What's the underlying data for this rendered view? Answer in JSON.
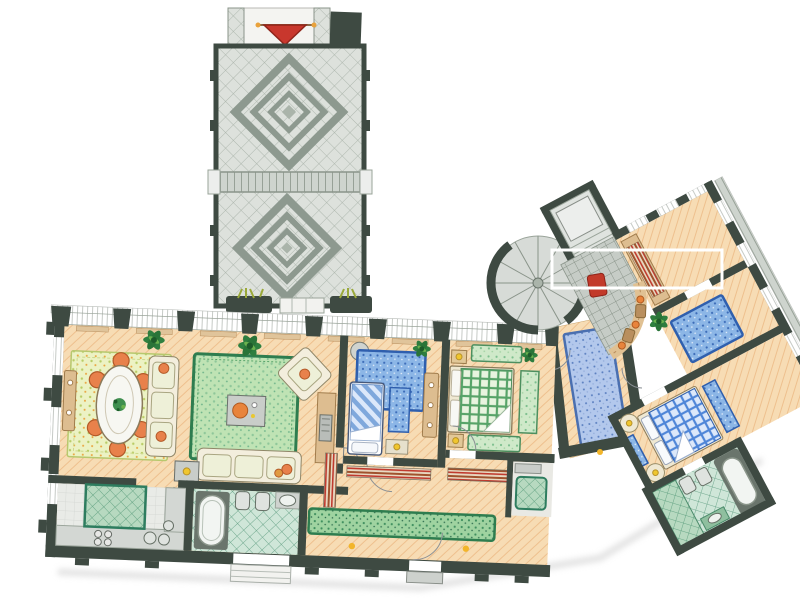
{
  "drawing": {
    "kind": "hand-rendered watercolor apartment floor plan",
    "view": "top-down plan",
    "background": "white"
  },
  "palette": {
    "wall": "#3e4a42",
    "peach": "#f7dcb4",
    "peachLine": "#eec08e",
    "rugGreenDark": "#2e7d4f",
    "blueDark": "#2f5fae",
    "tan": "#ddbd90",
    "tanDark": "#a07c4c",
    "orange": "#e8814b",
    "yellow": "#f0c62e",
    "red": "#c23a2a",
    "counter": "#d3d7d3",
    "terraceTile": "#dde1dc",
    "terraceMotif": "#8d998f",
    "bathTile": "#cfe6d8",
    "stairGrey": "#d7dbd7"
  },
  "courtyard": {
    "name": "tiled-courtyard",
    "features": [
      "entry-gate-with-red-awning",
      "dark-chimney-block",
      "upper-diamond-mosaic-panel",
      "tile-step-band",
      "lower-diamond-mosaic-panel",
      "two-dark-planters-with-grass"
    ]
  },
  "rooms": [
    {
      "name": "dining-room",
      "floor": "peach-hatched",
      "furniture": [
        "floral-green-rug",
        "white-oval-table-with-centerpiece-plant",
        "six-orange-chairs",
        "tan-sideboard",
        "potted-plants"
      ]
    },
    {
      "name": "living-room",
      "floor": "peach-hatched",
      "furniture": [
        "large-green-bordered-rug",
        "cream-sofa-left",
        "cream-sofa-bottom",
        "diagonal-corner-armchair",
        "grey-coffee-table-with-orange-tray",
        "grey-side-table-with-yellow-dot",
        "tan-fireplace-niche",
        "potted-plants"
      ]
    },
    {
      "name": "bedroom-small",
      "floor": "peach-hatched",
      "furniture": [
        "blue-speckled-rug",
        "single-bed-blue-striped",
        "bedside-blue-rug",
        "foot-bench-with-yellow-dot",
        "tan-wardrobe",
        "round-corner-table",
        "potted-plant"
      ]
    },
    {
      "name": "bedroom-master",
      "floor": "peach-hatched",
      "furniture": [
        "double-bed-green-checked-with-white-fold",
        "cream-headboard",
        "two-nightstands-with-yellow-dots",
        "green-rug-head",
        "green-rug-foot",
        "green-side-runner"
      ]
    },
    {
      "name": "kitchen",
      "floor": "pale-grey",
      "furniture": [
        "green-quilted-island",
        "grey-counter-run",
        "four-ring-cooktop",
        "twin-round-sinks",
        "double-french-doors"
      ]
    },
    {
      "name": "bathroom-main",
      "floor": "green-diamond-tile",
      "furniture": [
        "bathtub-on-dark-deck",
        "toilet",
        "bidet",
        "washbasin"
      ]
    },
    {
      "name": "hallway",
      "floor": "peach-hatched",
      "furniture": [
        "long-green-runner-rug",
        "striped-closet-shelving",
        "entrance-door",
        "porch-steps",
        "yellow-floor-markers"
      ]
    },
    {
      "name": "dressing-room",
      "floor": "pale-grey",
      "furniture": [
        "green-quilted-armchair",
        "grey-shelf"
      ]
    },
    {
      "name": "junction-hall",
      "floor": "peach-hatched",
      "furniture": [
        "long-blue-runner-rug"
      ]
    },
    {
      "name": "stair-lobby",
      "floor": "grey-grid-tile",
      "furniture": [
        "spiral-staircase",
        "landing-platform",
        "curved-tan-bench-with-orange-dots",
        "brown-stools",
        "red-chair",
        "white-void-outline"
      ]
    },
    {
      "name": "study",
      "floor": "peach-hatched",
      "furniture": [
        "tan-desk-band",
        "striped-bookshelf"
      ]
    },
    {
      "name": "wing-corridor",
      "floor": "peach-hatched",
      "furniture": [
        "blue-speckled-rug",
        "potted-plant"
      ]
    },
    {
      "name": "bedroom-guest",
      "floor": "peach-hatched",
      "furniture": [
        "double-bed-blue-checked",
        "white-pillows",
        "two-round-nightstands-with-yellow-dots",
        "two-bedside-blue-rugs"
      ]
    },
    {
      "name": "bathroom-ensuite",
      "floor": "green-diamond-tile",
      "furniture": [
        "bathtub-on-dark-deck",
        "toilet",
        "bidet",
        "green-washbasin"
      ]
    }
  ]
}
